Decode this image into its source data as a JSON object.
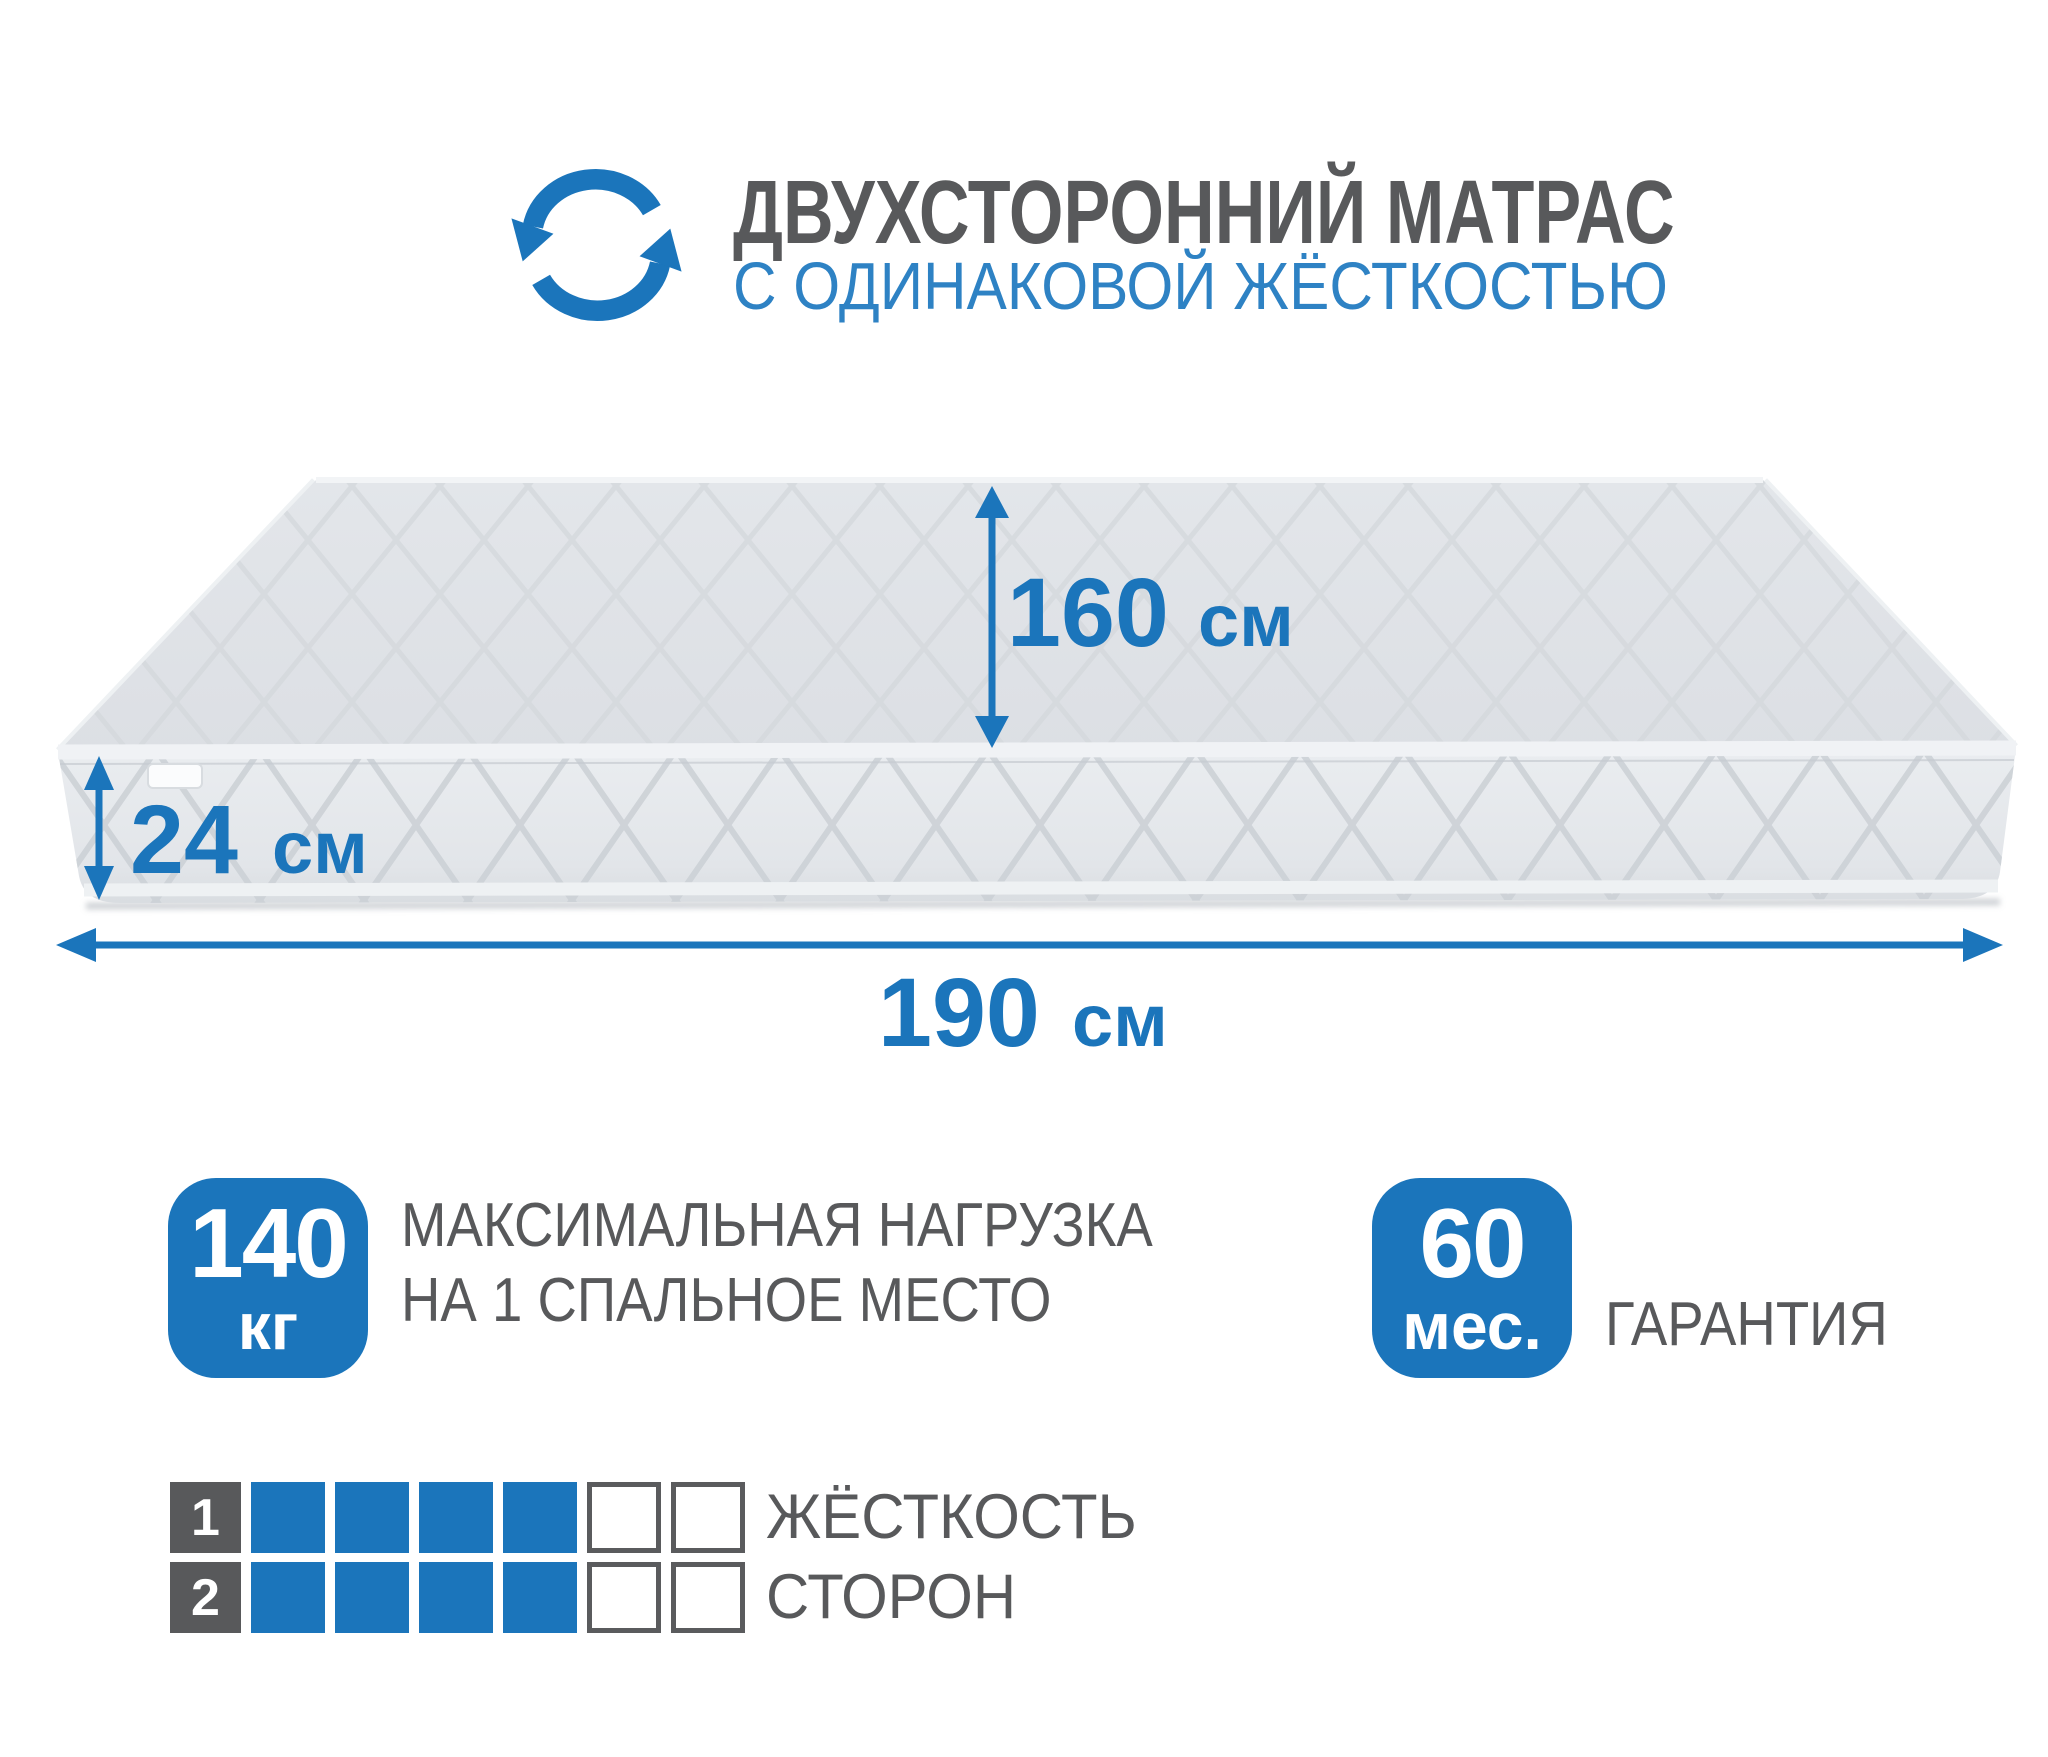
{
  "header": {
    "icon": "rotate-arrows-icon",
    "title": "ДВУХСТОРОННИЙ МАТРАС",
    "subtitle": "С ОДИНАКОВОЙ ЖЁСТКОСТЬЮ"
  },
  "mattress": {
    "description": "two-sided quilted mattress shown in 3d perspective with dimension arrows",
    "dimensions": {
      "depth": {
        "value": "160",
        "unit": "см"
      },
      "height": {
        "value": "24",
        "unit": "см"
      },
      "width": {
        "value": "190",
        "unit": "см"
      }
    }
  },
  "features": {
    "max_load": {
      "value": "140",
      "unit": "кг",
      "label_line1": "МАКСИМАЛЬНАЯ НАГРУЗКА",
      "label_line2": "НА 1 СПАЛЬНОЕ МЕСТО"
    },
    "warranty": {
      "value": "60",
      "unit": "мес.",
      "label": "ГАРАНТИЯ"
    }
  },
  "hardness_scale": {
    "label_line1": "ЖЁСТКОСТЬ",
    "label_line2": "СТОРОН",
    "rows": [
      {
        "side": "1",
        "filled": 4,
        "total": 6
      },
      {
        "side": "2",
        "filled": 4,
        "total": 6
      }
    ]
  },
  "colors": {
    "accent_blue": "#1b75bb",
    "subtitle_blue": "#2e82c4",
    "text_gray": "#58595b",
    "mattress_top": "#e0e3e7",
    "mattress_front": "#e6e9ec"
  }
}
